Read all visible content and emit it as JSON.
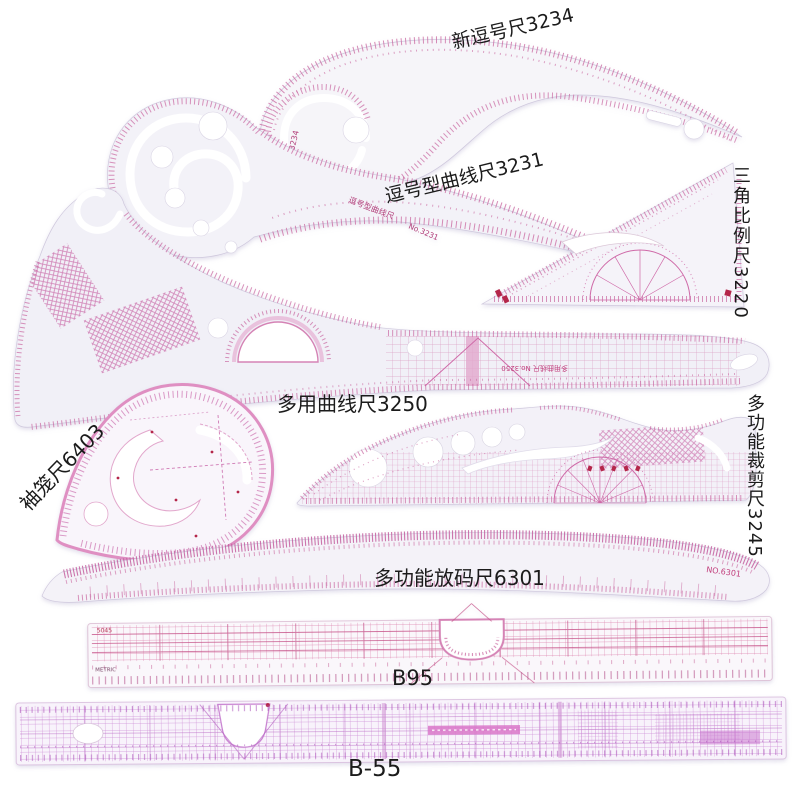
{
  "scene": {
    "description": "Product photo of a 9-piece sewing / tailoring pattern ruler set on white background",
    "background": "#ffffff",
    "item_count": 9
  },
  "labels": {
    "ruler_3234": "新逗号尺3234",
    "ruler_3231": "逗号型曲线尺3231",
    "ruler_3220": "三角比例尺3220",
    "ruler_3250": "多用曲线尺3250",
    "ruler_6403": "袖笼尺6403",
    "ruler_3245": "多功能裁剪尺3245",
    "ruler_6301": "多功能放码尺6301",
    "ruler_b95": "B95",
    "ruler_b55": "B-55"
  },
  "ruler_prints": {
    "no_3234": "NO.3234",
    "no_3231": "No.3231",
    "name_3231": "逗号型曲线尺",
    "no_3250": "多用曲线尺 No.3250",
    "no_6301": "NO.6301",
    "b95_code": "5045",
    "b95_metric": "METRIC"
  },
  "colors": {
    "marking_pink": "#c9659f",
    "marking_magenta": "#b867c4",
    "marking_red": "#b4264a",
    "ruler_body": "#f4f2f8",
    "label_black": "#1b1b1b"
  }
}
